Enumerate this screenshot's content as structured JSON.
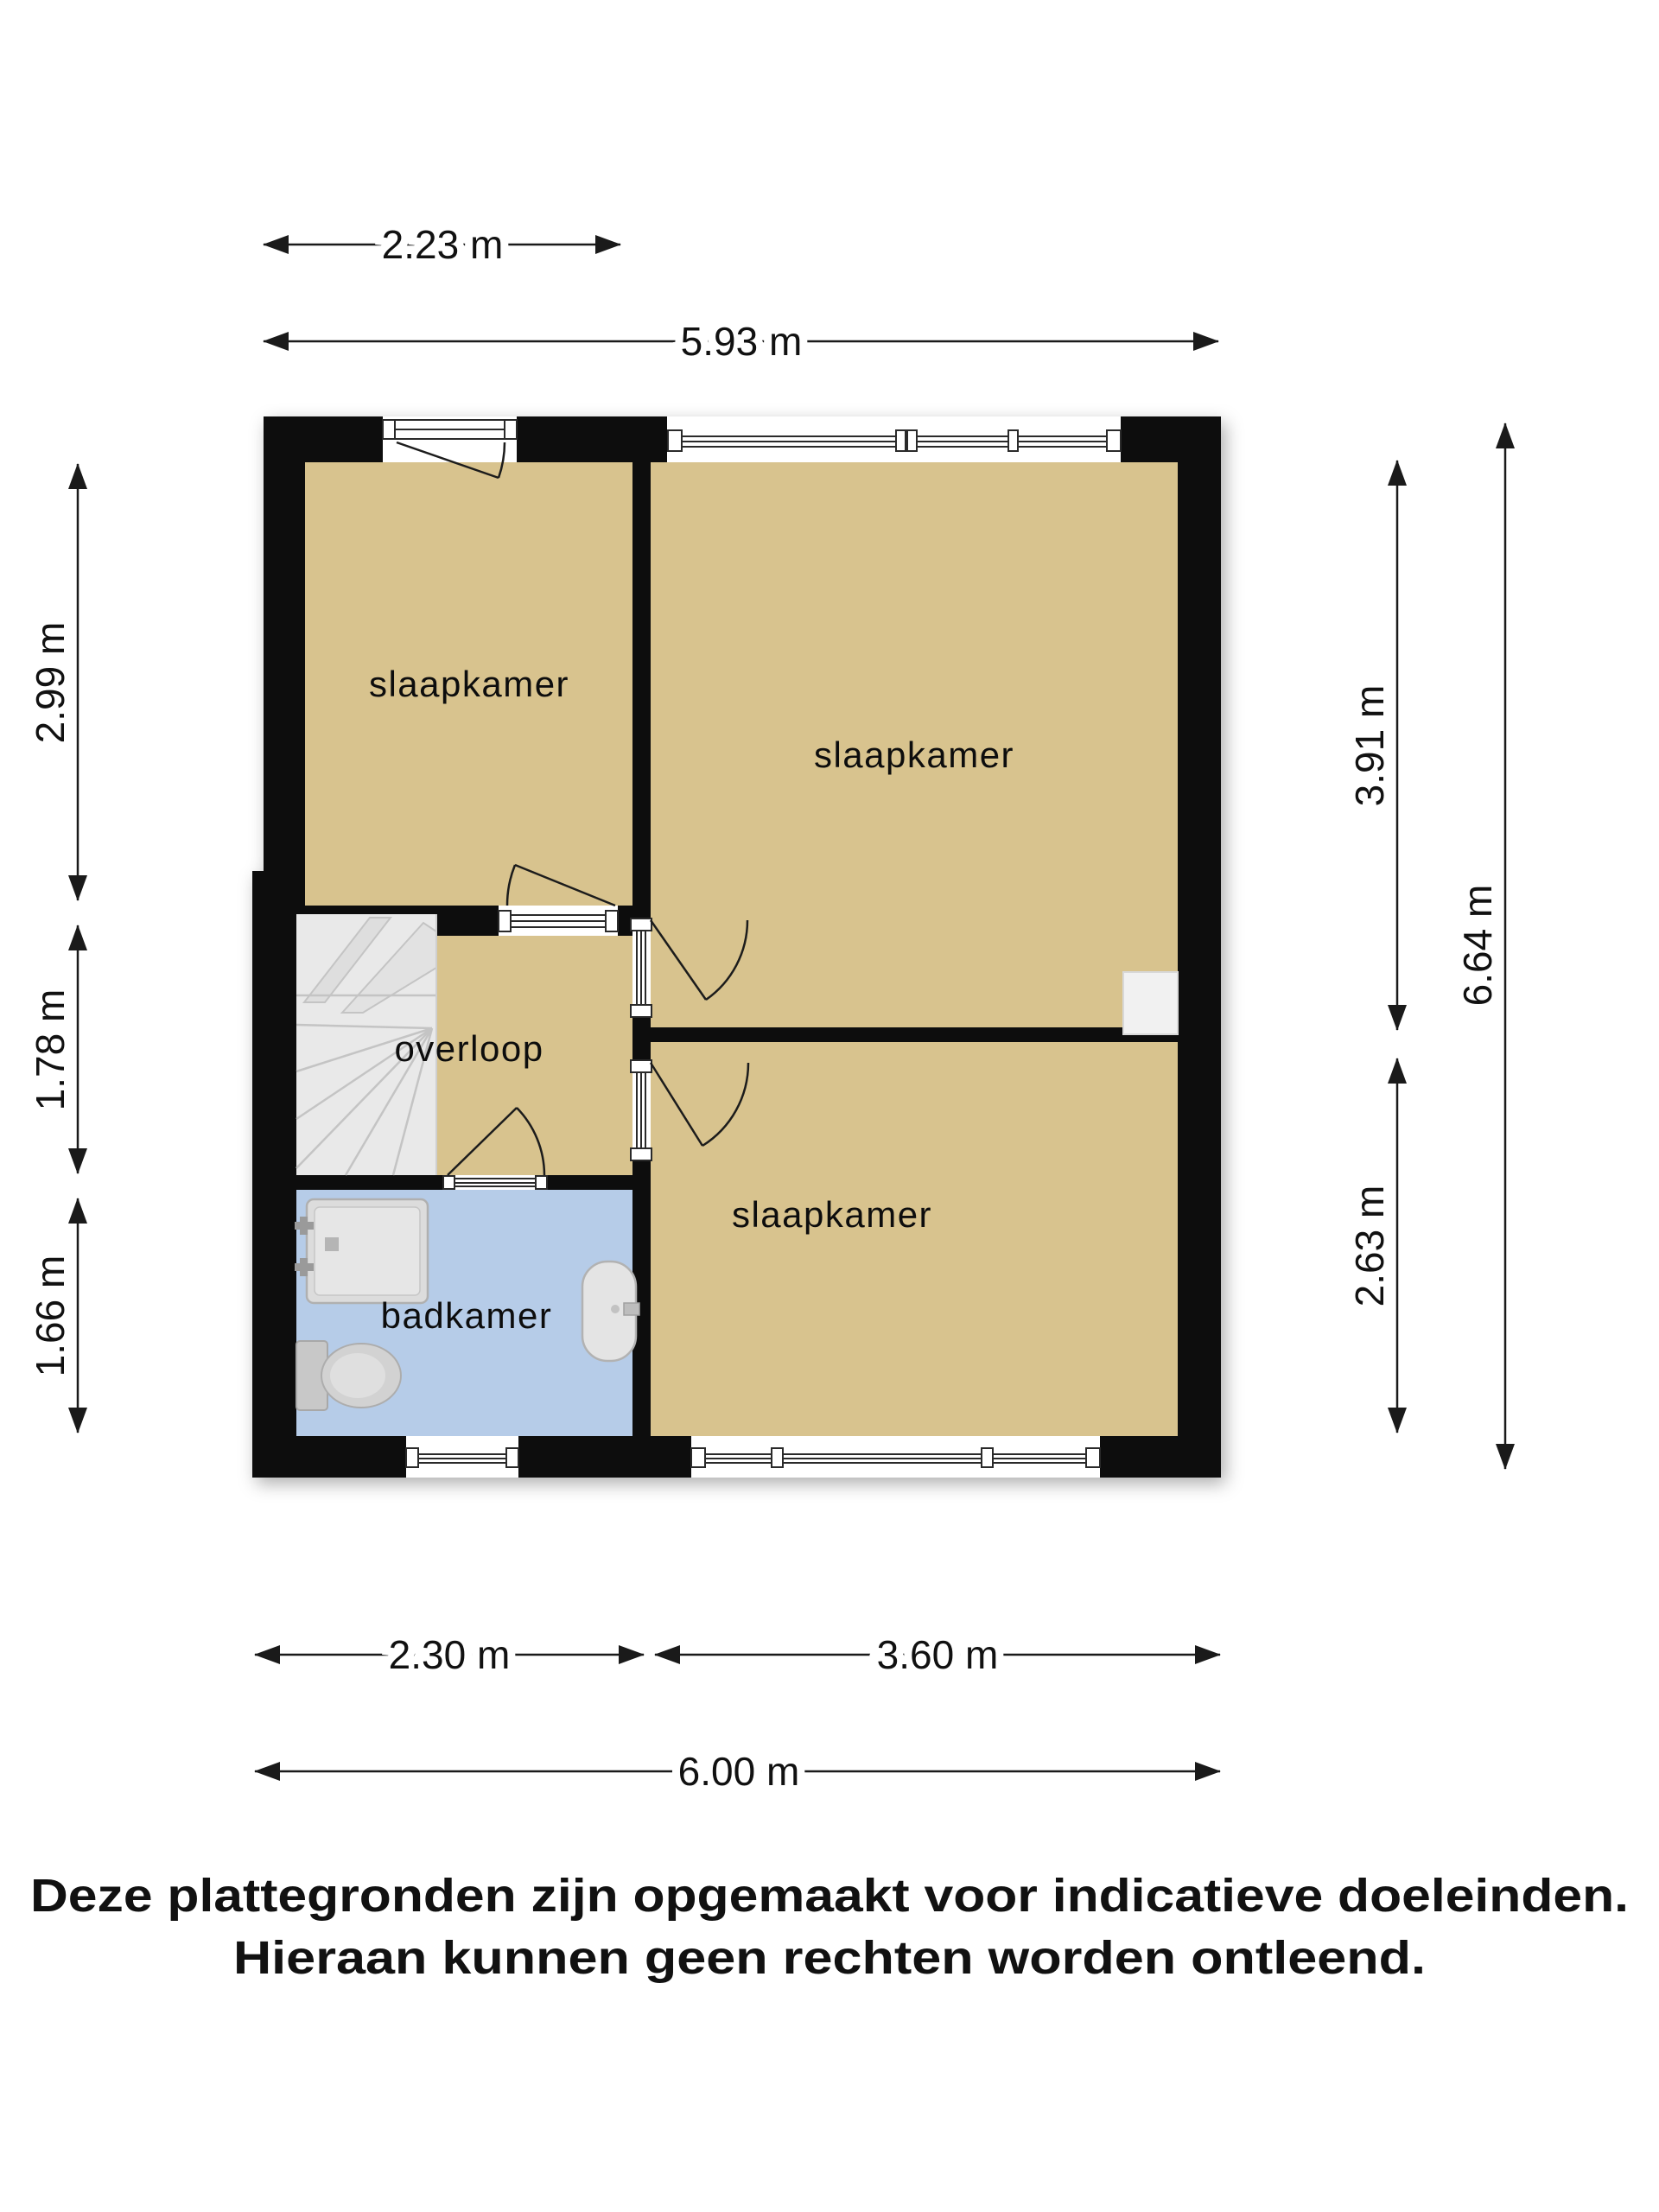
{
  "plan": {
    "rooms": [
      {
        "id": "bedroom-top-left",
        "label": "slaapkamer"
      },
      {
        "id": "bedroom-top-right",
        "label": "slaapkamer"
      },
      {
        "id": "bedroom-bottom",
        "label": "slaapkamer"
      },
      {
        "id": "landing",
        "label": "overloop"
      },
      {
        "id": "bathroom",
        "label": "badkamer"
      }
    ],
    "colors": {
      "wall": "#0d0d0d",
      "room": "#d8c38e",
      "bathroom": "#b6cce8",
      "stairs": "#e9e9e9",
      "duct": "#f1f1f1"
    },
    "fixtures": [
      "stairs",
      "shower",
      "toilet",
      "sink",
      "duct"
    ]
  },
  "dimensions": {
    "top": [
      {
        "label": "2.23 m",
        "meters": 2.23
      },
      {
        "label": "5.93 m",
        "meters": 5.93
      }
    ],
    "left": [
      {
        "label": "2.99 m",
        "meters": 2.99
      },
      {
        "label": "1.78 m",
        "meters": 1.78
      },
      {
        "label": "1.66 m",
        "meters": 1.66
      }
    ],
    "right": [
      {
        "label": "3.91 m",
        "meters": 3.91
      },
      {
        "label": "2.63 m",
        "meters": 2.63
      },
      {
        "label": "6.64 m",
        "meters": 6.64
      }
    ],
    "bottom": [
      {
        "label": "2.30 m",
        "meters": 2.3
      },
      {
        "label": "3.60 m",
        "meters": 3.6
      },
      {
        "label": "6.00 m",
        "meters": 6.0
      }
    ]
  },
  "disclaimer": {
    "line1": "Deze plattegronden zijn opgemaakt voor indicatieve doeleinden.",
    "line2": "Hieraan kunnen geen rechten worden ontleend."
  }
}
